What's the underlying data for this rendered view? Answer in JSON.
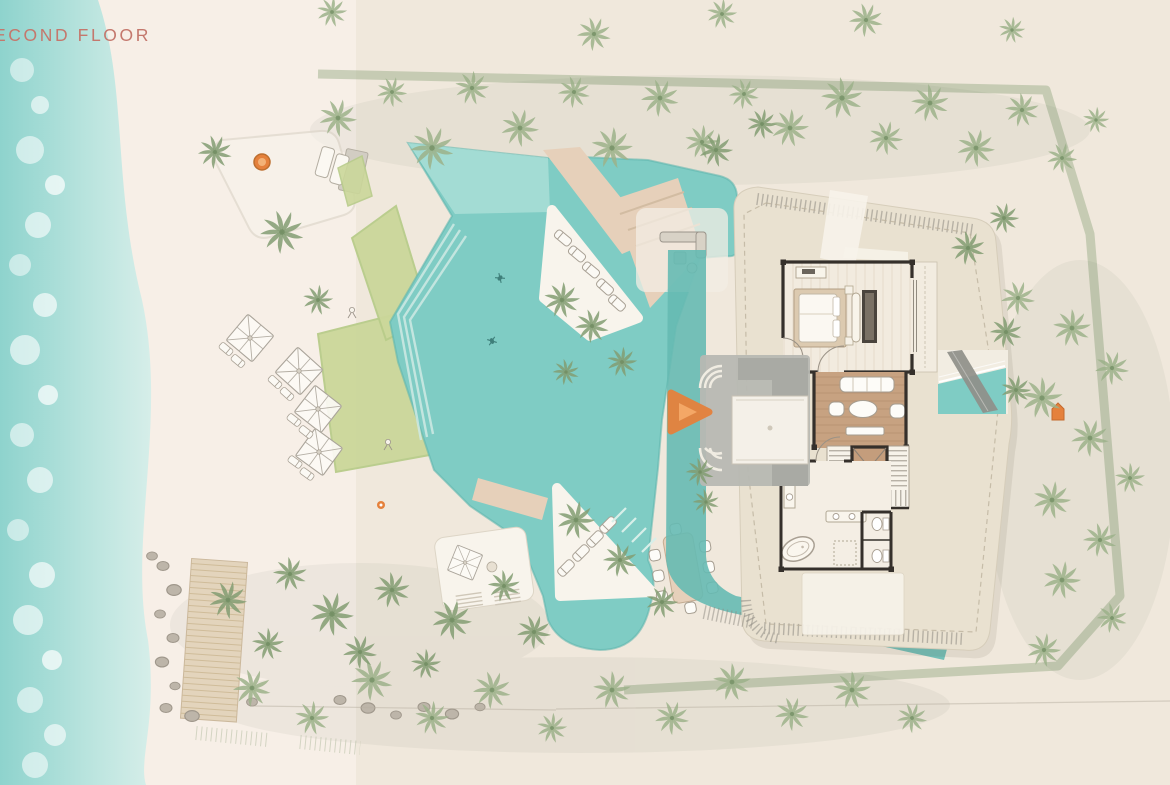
{
  "header": {
    "title": "ECOND FLOOR"
  },
  "colors": {
    "title_text": "#c4786d",
    "ocean_deep": "#8ed3cd",
    "ocean_light": "#d6eee9",
    "surf_foam": "#ffffff",
    "beach_sand": "#f7efe7",
    "site_sand": "#f0e8dc",
    "boundary_hedge": "#93a981",
    "palm_green": "#9cb289",
    "palm_green_dark": "#829c72",
    "lawn_green": "#cbd79a",
    "path_white": "#f7f3ec",
    "pool_water": "#7fccc4",
    "pool_water_deep": "#66bab2",
    "pool_shallow": "#a9ded6",
    "deck_tan": "#e6d0ba",
    "deck_white": "#f8f4ec",
    "roof_beige": "#e9e1d0",
    "wood_floor": "#c7a281",
    "wall_dark": "#35302b",
    "furniture_white": "#fdfcf8",
    "furniture_stroke": "#a59d90",
    "terrace_gray": "#b7b8b2",
    "terrace_gray_dark": "#a9aaa4",
    "accent_orange": "#e5813c",
    "rock_gray": "#bdb5a9",
    "boardwalk_tan": "#e3d4bc",
    "railing_gray": "#8e8a82"
  }
}
